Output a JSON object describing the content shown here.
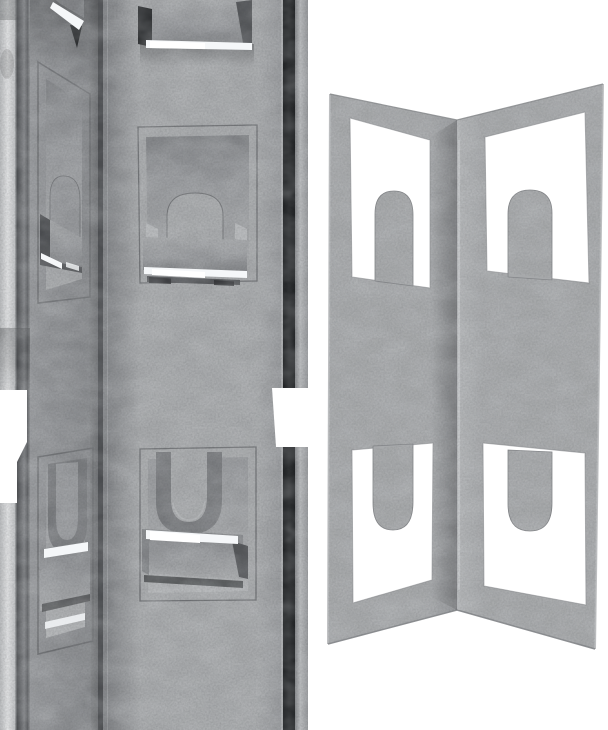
{
  "image": {
    "type": "product-photo-render",
    "subject": "galvanized steel corner bracket with keyhole slots and bent hook tabs",
    "views": [
      {
        "id": "left-closeup",
        "description": "Close-up of bracket inside corner: embossed rectangular panels, rounded keyhole tongues and bent-out hook bars with bright specular edges"
      },
      {
        "id": "right-full",
        "description": "Full open corner bracket standing like an open book; each face has an upper window with rising rounded tongue and a lower window with hanging rounded tongue"
      }
    ]
  },
  "colors": {
    "background": "#ffffff",
    "metal_light": "#b4b6b8",
    "metal_base": "#a7a9ab",
    "metal_mid": "#96989b",
    "metal_shade": "#828487",
    "metal_frame_dark": "#6e7073",
    "channel_dark": "#797b7e",
    "edge_dark": "#2e3032",
    "fold_dark": "#4b4d50",
    "shadow_line": "#55575a",
    "flange_light": "#e2e3e4",
    "edge_band_light": "#b7b9bb",
    "specular": "#f5f7f9"
  }
}
